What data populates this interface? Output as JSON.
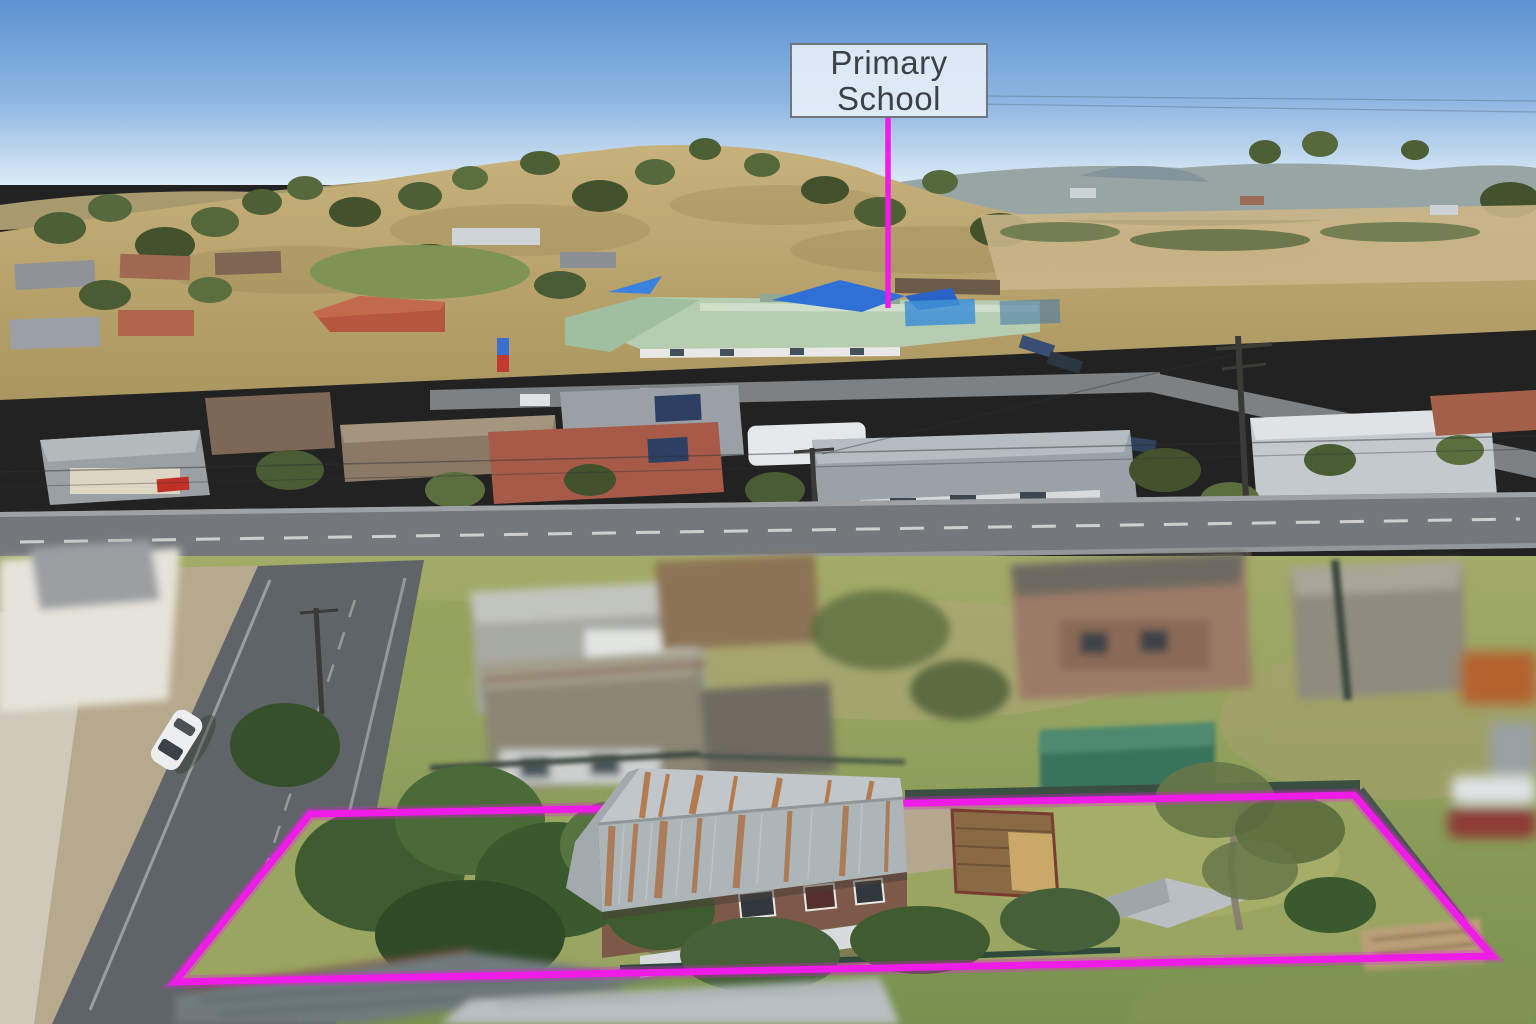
{
  "annotation": {
    "school_label": {
      "line1": "Primary",
      "line2": "School"
    },
    "highlight_color": "#ee1ce6",
    "label": {
      "background": "rgba(230,239,248,0.9)",
      "border_color": "#70767c",
      "text_color": "#3d4145"
    }
  },
  "scene": {
    "kind": "aerial-drone-photo",
    "subject": "residential property outlined in magenta with primary school marked in background"
  }
}
